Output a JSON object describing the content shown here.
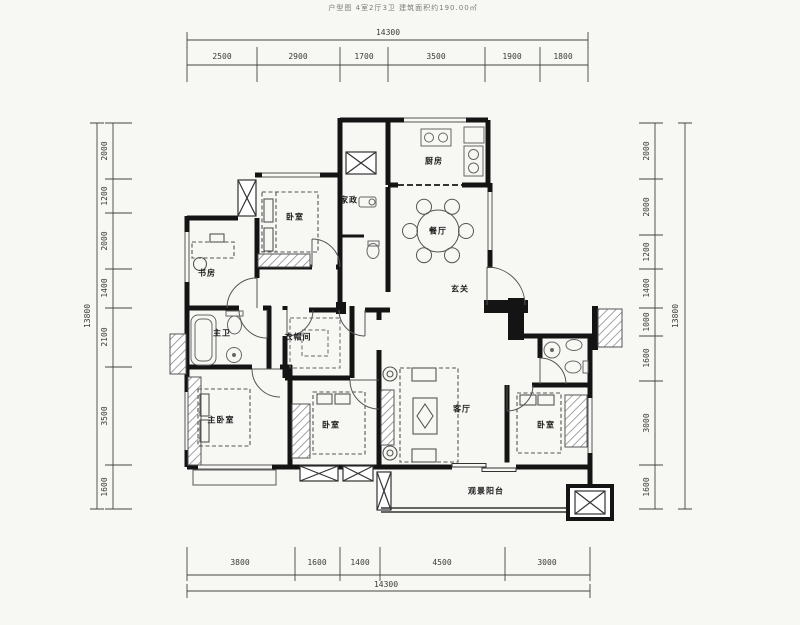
{
  "header": {
    "title": "户型图 4室2厅3卫 建筑面积约190.00㎡"
  },
  "colors": {
    "wall": "#141414",
    "dimension_line": "#3a3a3a",
    "furniture_line": "#666666",
    "label_text": "#1d1d1d",
    "background": "#f7f7f4"
  },
  "floor_plan": {
    "room_labels": [
      {
        "text": "厨房",
        "x": 434,
        "y": 162
      },
      {
        "text": "家政",
        "x": 349,
        "y": 201
      },
      {
        "text": "卧室",
        "x": 295,
        "y": 218
      },
      {
        "text": "书房",
        "x": 207,
        "y": 274
      },
      {
        "text": "餐厅",
        "x": 438,
        "y": 232
      },
      {
        "text": "玄关",
        "x": 460,
        "y": 290
      },
      {
        "text": "主卫",
        "x": 222,
        "y": 334
      },
      {
        "text": "衣帽间",
        "x": 298,
        "y": 338
      },
      {
        "text": "主卧室",
        "x": 221,
        "y": 421
      },
      {
        "text": "卧室",
        "x": 331,
        "y": 426
      },
      {
        "text": "客厅",
        "x": 462,
        "y": 410
      },
      {
        "text": "卧室",
        "x": 546,
        "y": 426
      },
      {
        "text": "观景阳台",
        "x": 486,
        "y": 492
      }
    ]
  },
  "dimensions": {
    "top": {
      "total": {
        "text": "14300",
        "x": 388,
        "y": 33
      },
      "segments": [
        {
          "text": "2500",
          "x": 222,
          "y": 57
        },
        {
          "text": "2900",
          "x": 298,
          "y": 57
        },
        {
          "text": "1700",
          "x": 364,
          "y": 57
        },
        {
          "text": "3500",
          "x": 436,
          "y": 57
        },
        {
          "text": "1900",
          "x": 512,
          "y": 57
        },
        {
          "text": "1800",
          "x": 563,
          "y": 57
        }
      ]
    },
    "bottom": {
      "total": {
        "text": "14300",
        "x": 386,
        "y": 585
      },
      "segments": [
        {
          "text": "3800",
          "x": 240,
          "y": 563
        },
        {
          "text": "1600",
          "x": 317,
          "y": 563
        },
        {
          "text": "1400",
          "x": 360,
          "y": 563
        },
        {
          "text": "4500",
          "x": 442,
          "y": 563
        },
        {
          "text": "3000",
          "x": 547,
          "y": 563
        }
      ]
    },
    "left": {
      "total": {
        "text": "13800",
        "x": 88,
        "y": 316,
        "rotated": true
      },
      "segments": [
        {
          "text": "2000",
          "x": 105,
          "y": 151,
          "rotated": true
        },
        {
          "text": "1200",
          "x": 105,
          "y": 196,
          "rotated": true
        },
        {
          "text": "2000",
          "x": 105,
          "y": 241,
          "rotated": true
        },
        {
          "text": "1400",
          "x": 105,
          "y": 288,
          "rotated": true
        },
        {
          "text": "2100",
          "x": 105,
          "y": 337,
          "rotated": true
        },
        {
          "text": "3500",
          "x": 105,
          "y": 416,
          "rotated": true
        },
        {
          "text": "1600",
          "x": 105,
          "y": 487,
          "rotated": true
        }
      ]
    },
    "right": {
      "total": {
        "text": "13800",
        "x": 676,
        "y": 316,
        "rotated": true
      },
      "segments": [
        {
          "text": "2000",
          "x": 647,
          "y": 151,
          "rotated": true
        },
        {
          "text": "2000",
          "x": 647,
          "y": 207,
          "rotated": true
        },
        {
          "text": "1200",
          "x": 647,
          "y": 252,
          "rotated": true
        },
        {
          "text": "1400",
          "x": 647,
          "y": 288,
          "rotated": true
        },
        {
          "text": "1000",
          "x": 647,
          "y": 322,
          "rotated": true
        },
        {
          "text": "1600",
          "x": 647,
          "y": 358,
          "rotated": true
        },
        {
          "text": "3000",
          "x": 647,
          "y": 423,
          "rotated": true
        },
        {
          "text": "1600",
          "x": 647,
          "y": 487,
          "rotated": true
        }
      ]
    }
  }
}
